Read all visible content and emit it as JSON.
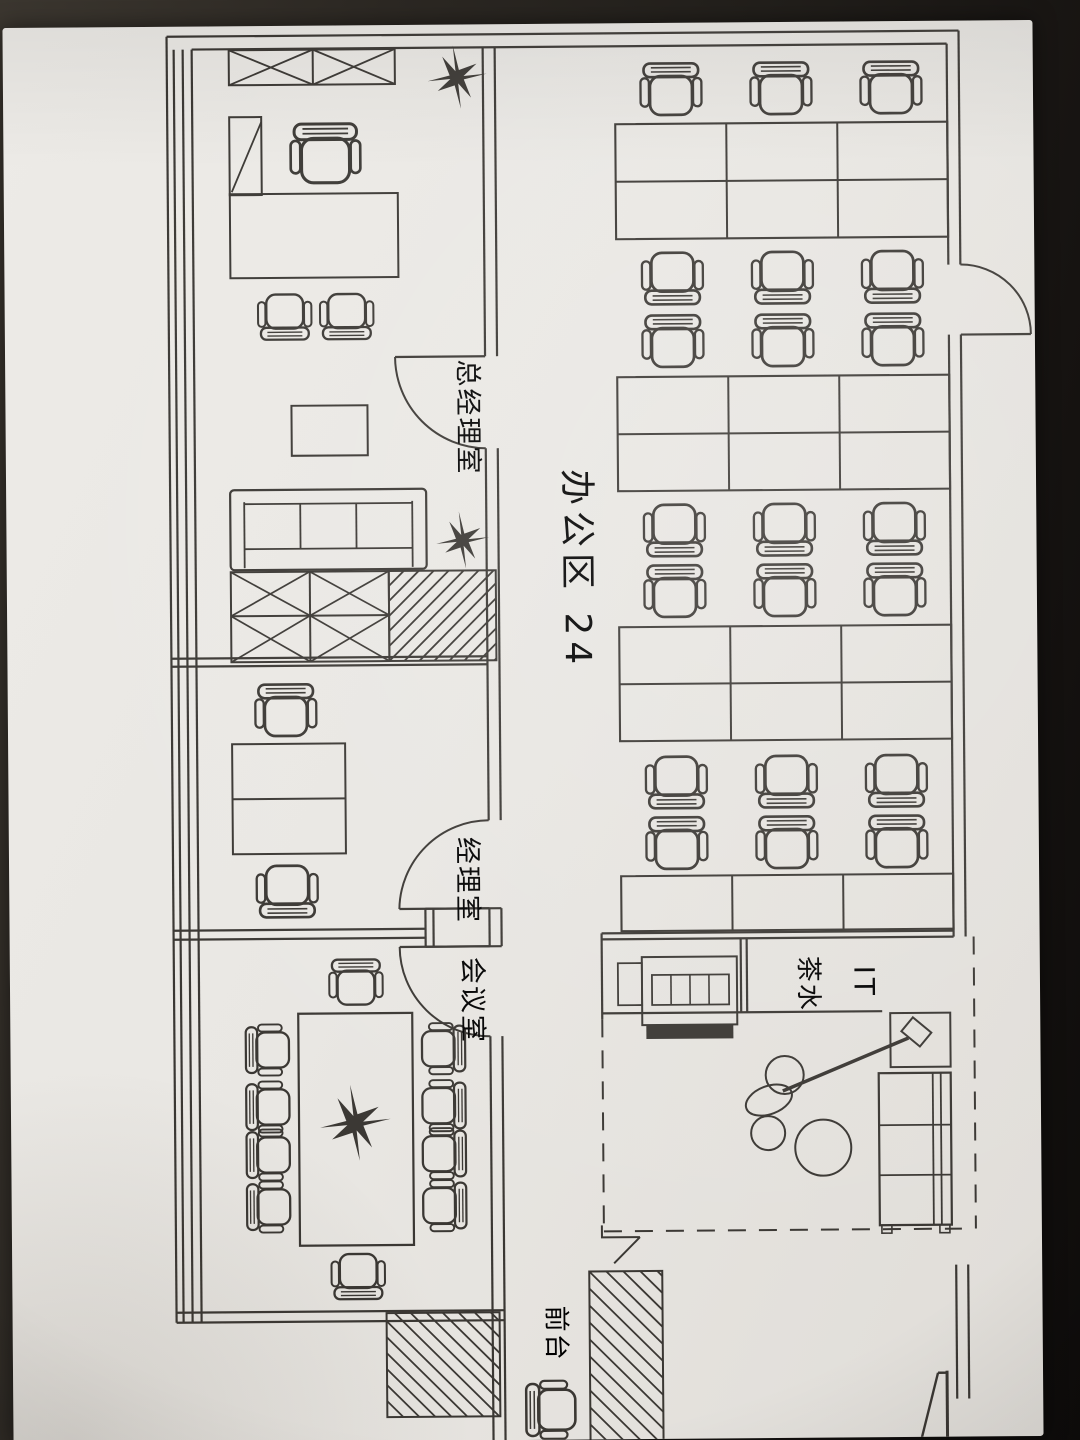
{
  "labels": {
    "gm_office": "总经理室",
    "manager_office": "经理室",
    "meeting_room": "会议室",
    "open_office": "办公区 24",
    "tea_water": "茶水",
    "it": "IT",
    "reception": "前台"
  },
  "colors": {
    "photo_background": "#26221e",
    "paper": "#e9e7e3",
    "ink": "#302d29"
  }
}
